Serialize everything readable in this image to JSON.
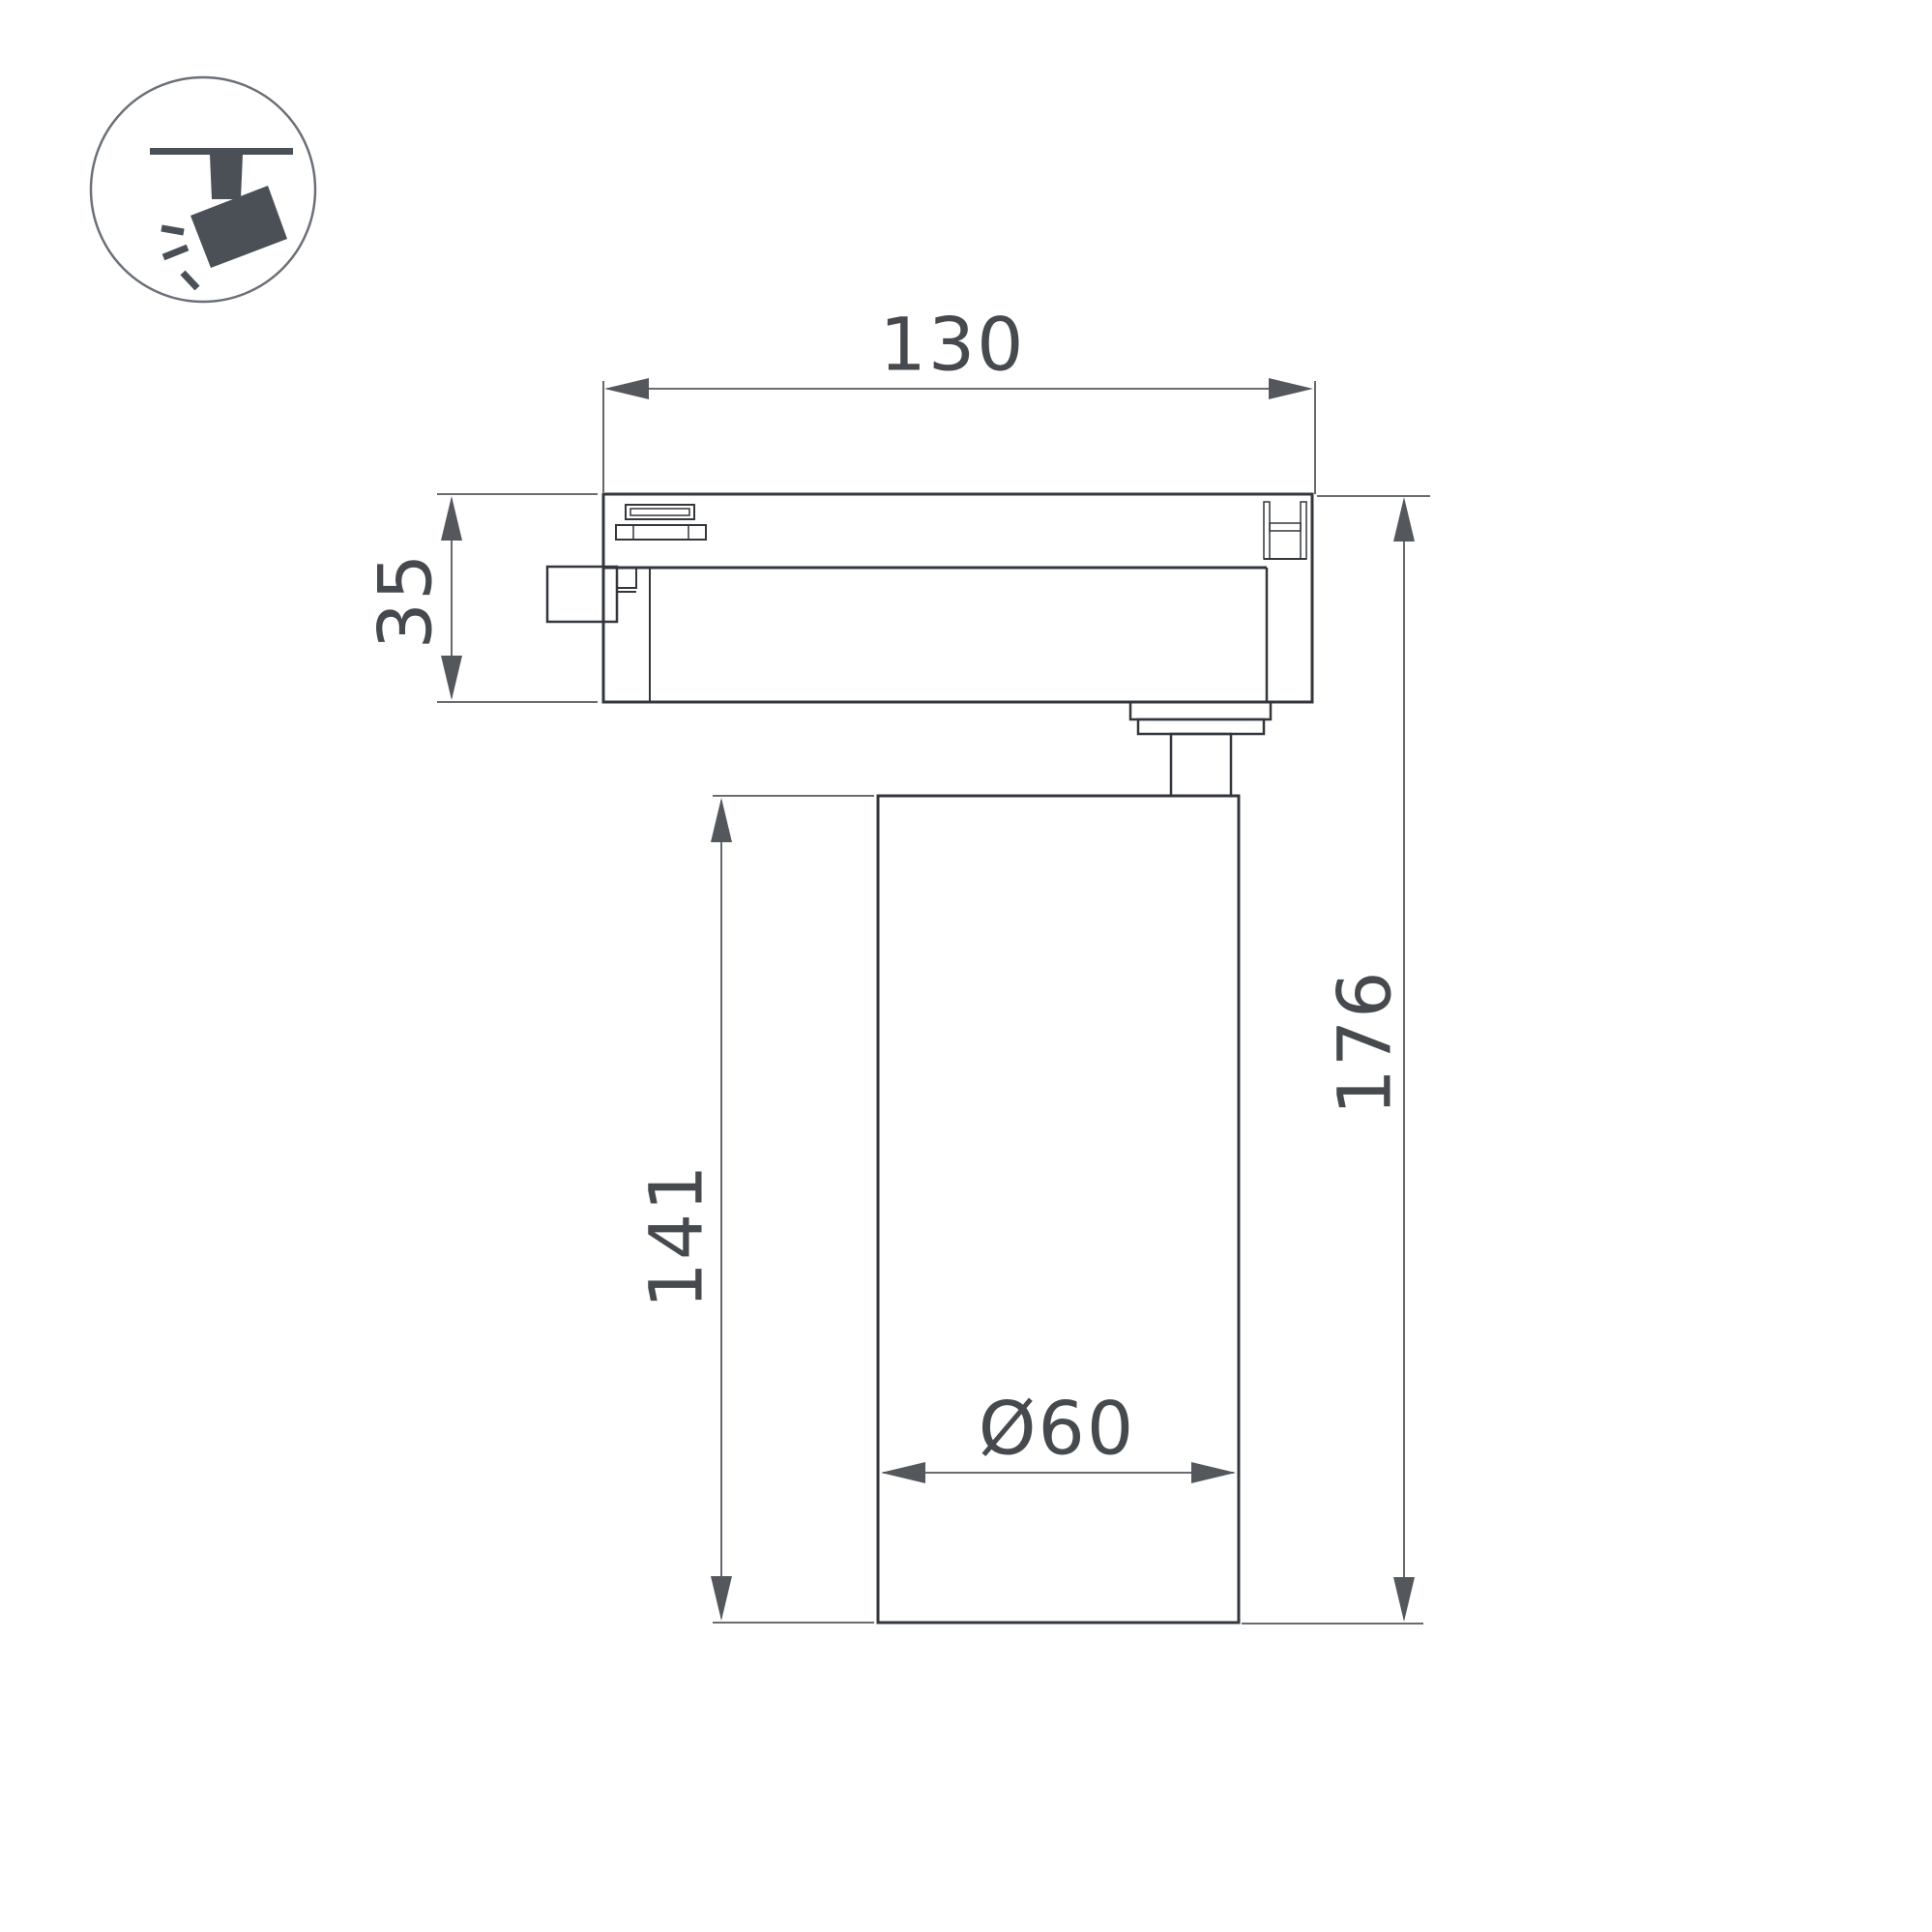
{
  "page": {
    "background": "#ffffff"
  },
  "icon": {
    "name": "track-spotlight",
    "color": "#4a5056",
    "circle_color": "#6b7077"
  },
  "drawing": {
    "line_color": "#33373c",
    "dim_color": "#54575c",
    "text_color": "#46494e",
    "labels": {
      "track_width": "130",
      "adapter_height": "35",
      "body_height": "141",
      "overall_height": "176",
      "body_diameter": "Ø60"
    }
  }
}
